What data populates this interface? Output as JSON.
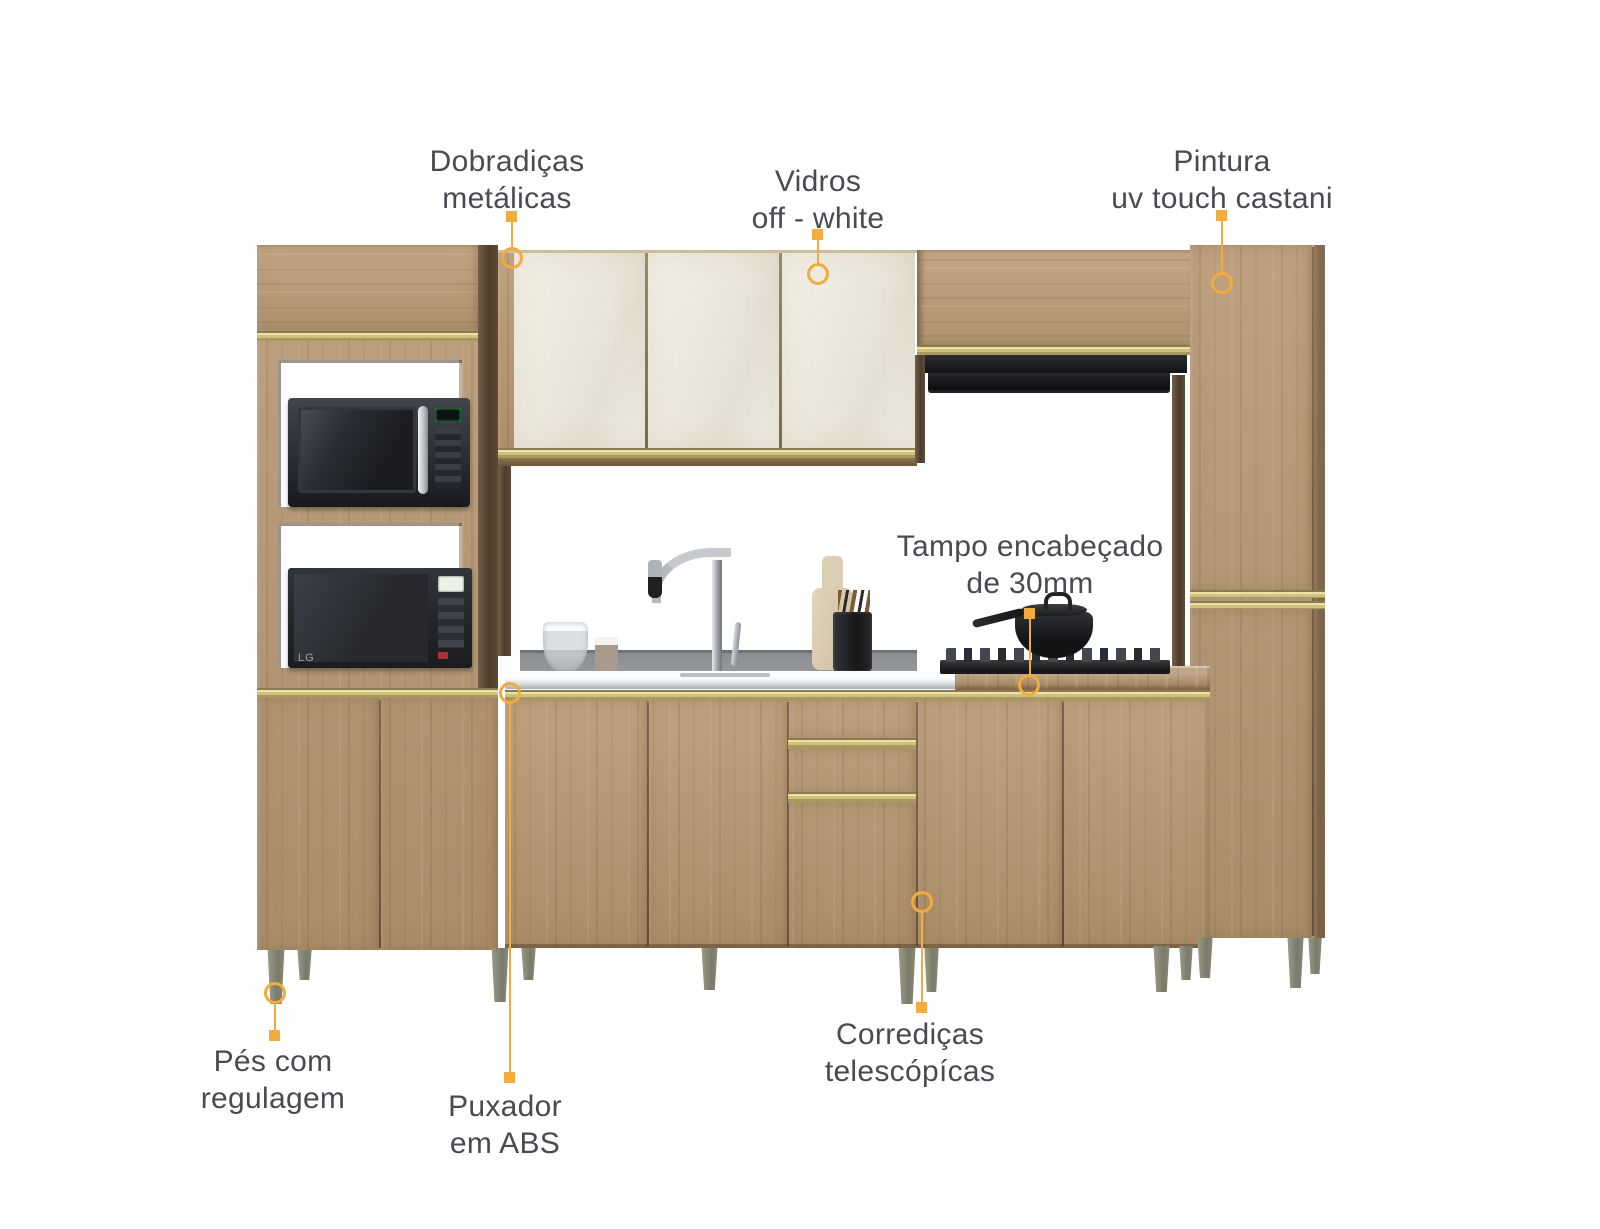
{
  "callouts": {
    "dobradicas": {
      "lines": [
        "Dobradiças",
        "metálicas"
      ]
    },
    "vidros": {
      "lines": [
        "Vidros",
        "off - white"
      ]
    },
    "pintura": {
      "lines": [
        "Pintura",
        "uv touch castani"
      ]
    },
    "tampo": {
      "lines": [
        "Tampo encabeçado",
        "de 30mm"
      ]
    },
    "pes": {
      "lines": [
        "Pés com",
        "regulagem"
      ]
    },
    "puxador": {
      "lines": [
        "Puxador",
        "em ABS"
      ]
    },
    "corredicas": {
      "lines": [
        "Corrediças",
        "telescópícas"
      ]
    }
  },
  "appliances": {
    "microwave_lower_brand": "LG"
  },
  "colors": {
    "accent": "#F1AC3D",
    "label_text": "#494B53",
    "wood": "#B79771",
    "wood_dark_edge": "#5D4A36",
    "gold_trim": "#CFC27F",
    "glass_offwhite": "#EDEAE0",
    "backsplash": "#83878A",
    "countertop": "#E8EAEC",
    "feet": "#8D8B79"
  }
}
